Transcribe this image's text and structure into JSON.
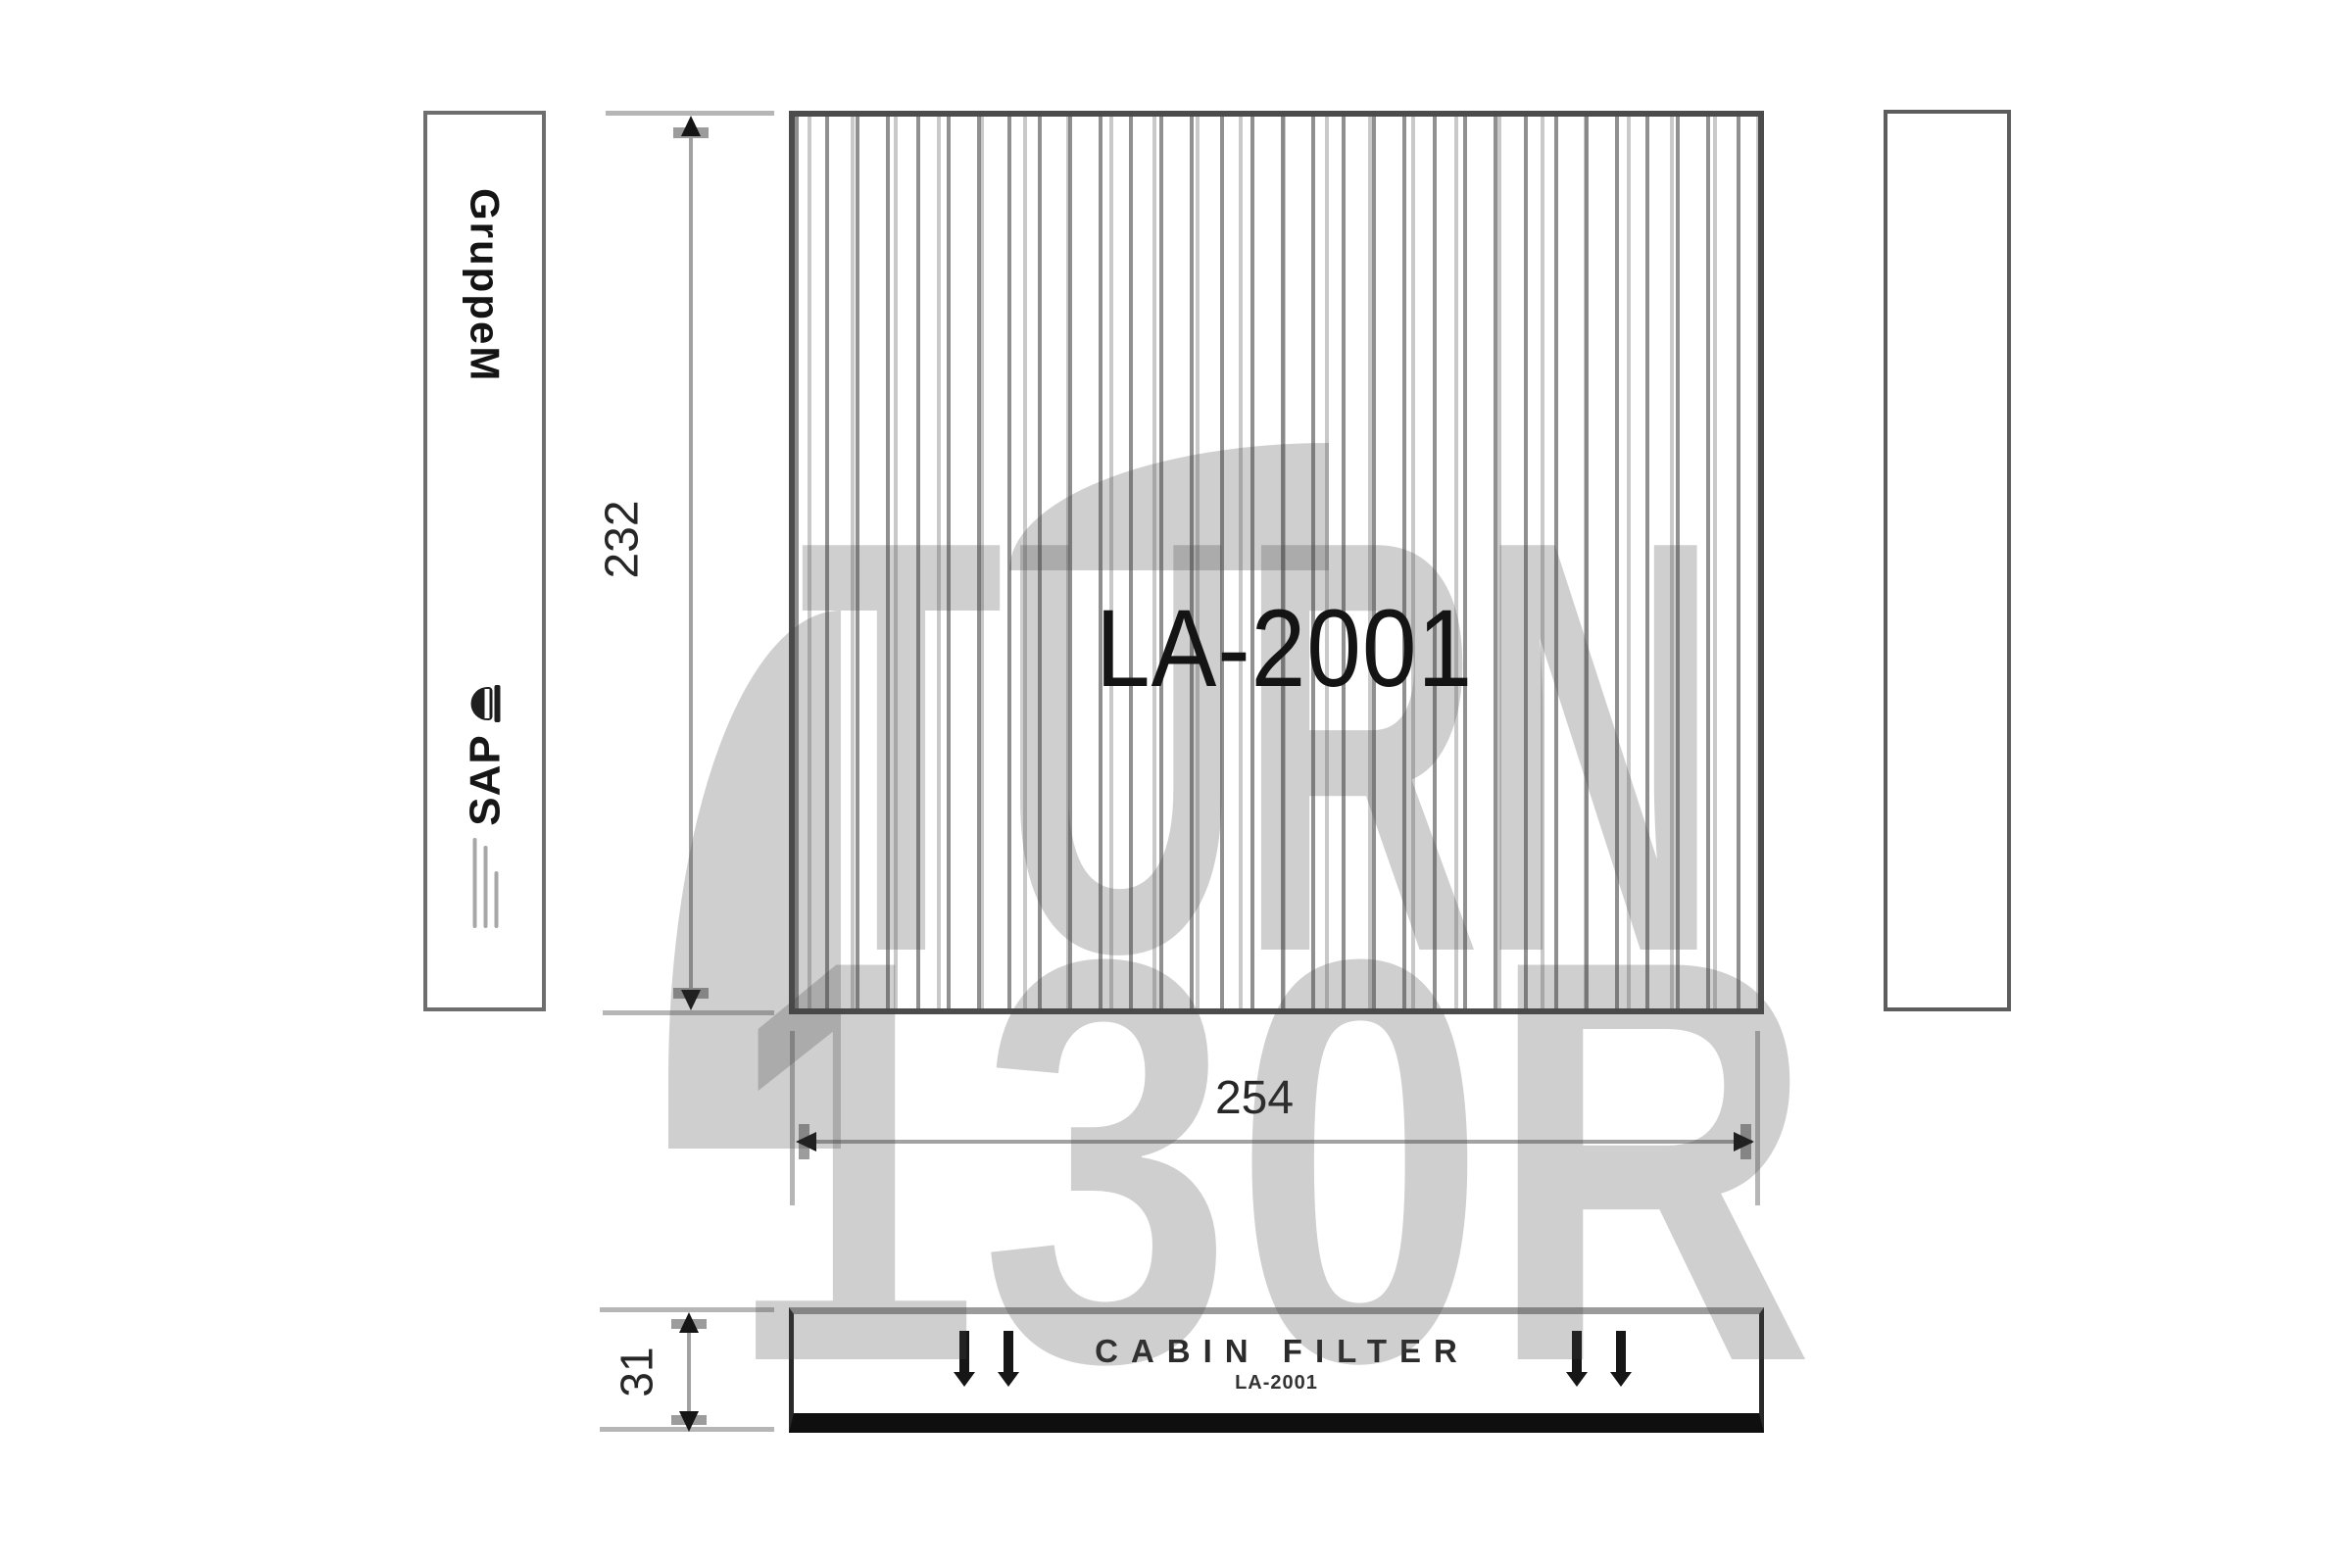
{
  "canvas": {
    "background": "#ffffff"
  },
  "part": {
    "top_view_label": "LA-2001",
    "side_view_title": "CABIN FILTER",
    "side_view_label": "LA-2001"
  },
  "branding": {
    "left_strip_brand": "GruppeM",
    "left_strip_logo": "SAP"
  },
  "dimensions": {
    "height_mm": "232",
    "width_mm": "254",
    "thickness_mm": "31"
  },
  "watermark": {
    "line1": "TURN",
    "line2": "130R"
  },
  "colors": {
    "outline": "#4c4c4c",
    "dimension_line": "#a2a2a2",
    "arrow": "#151515",
    "pleat_dark": "#7d7d7d",
    "pleat_light": "#b2b2b2",
    "watermark_gray": "rgba(68,68,68,0.26)",
    "side_view_base": "#0f0f0f"
  }
}
